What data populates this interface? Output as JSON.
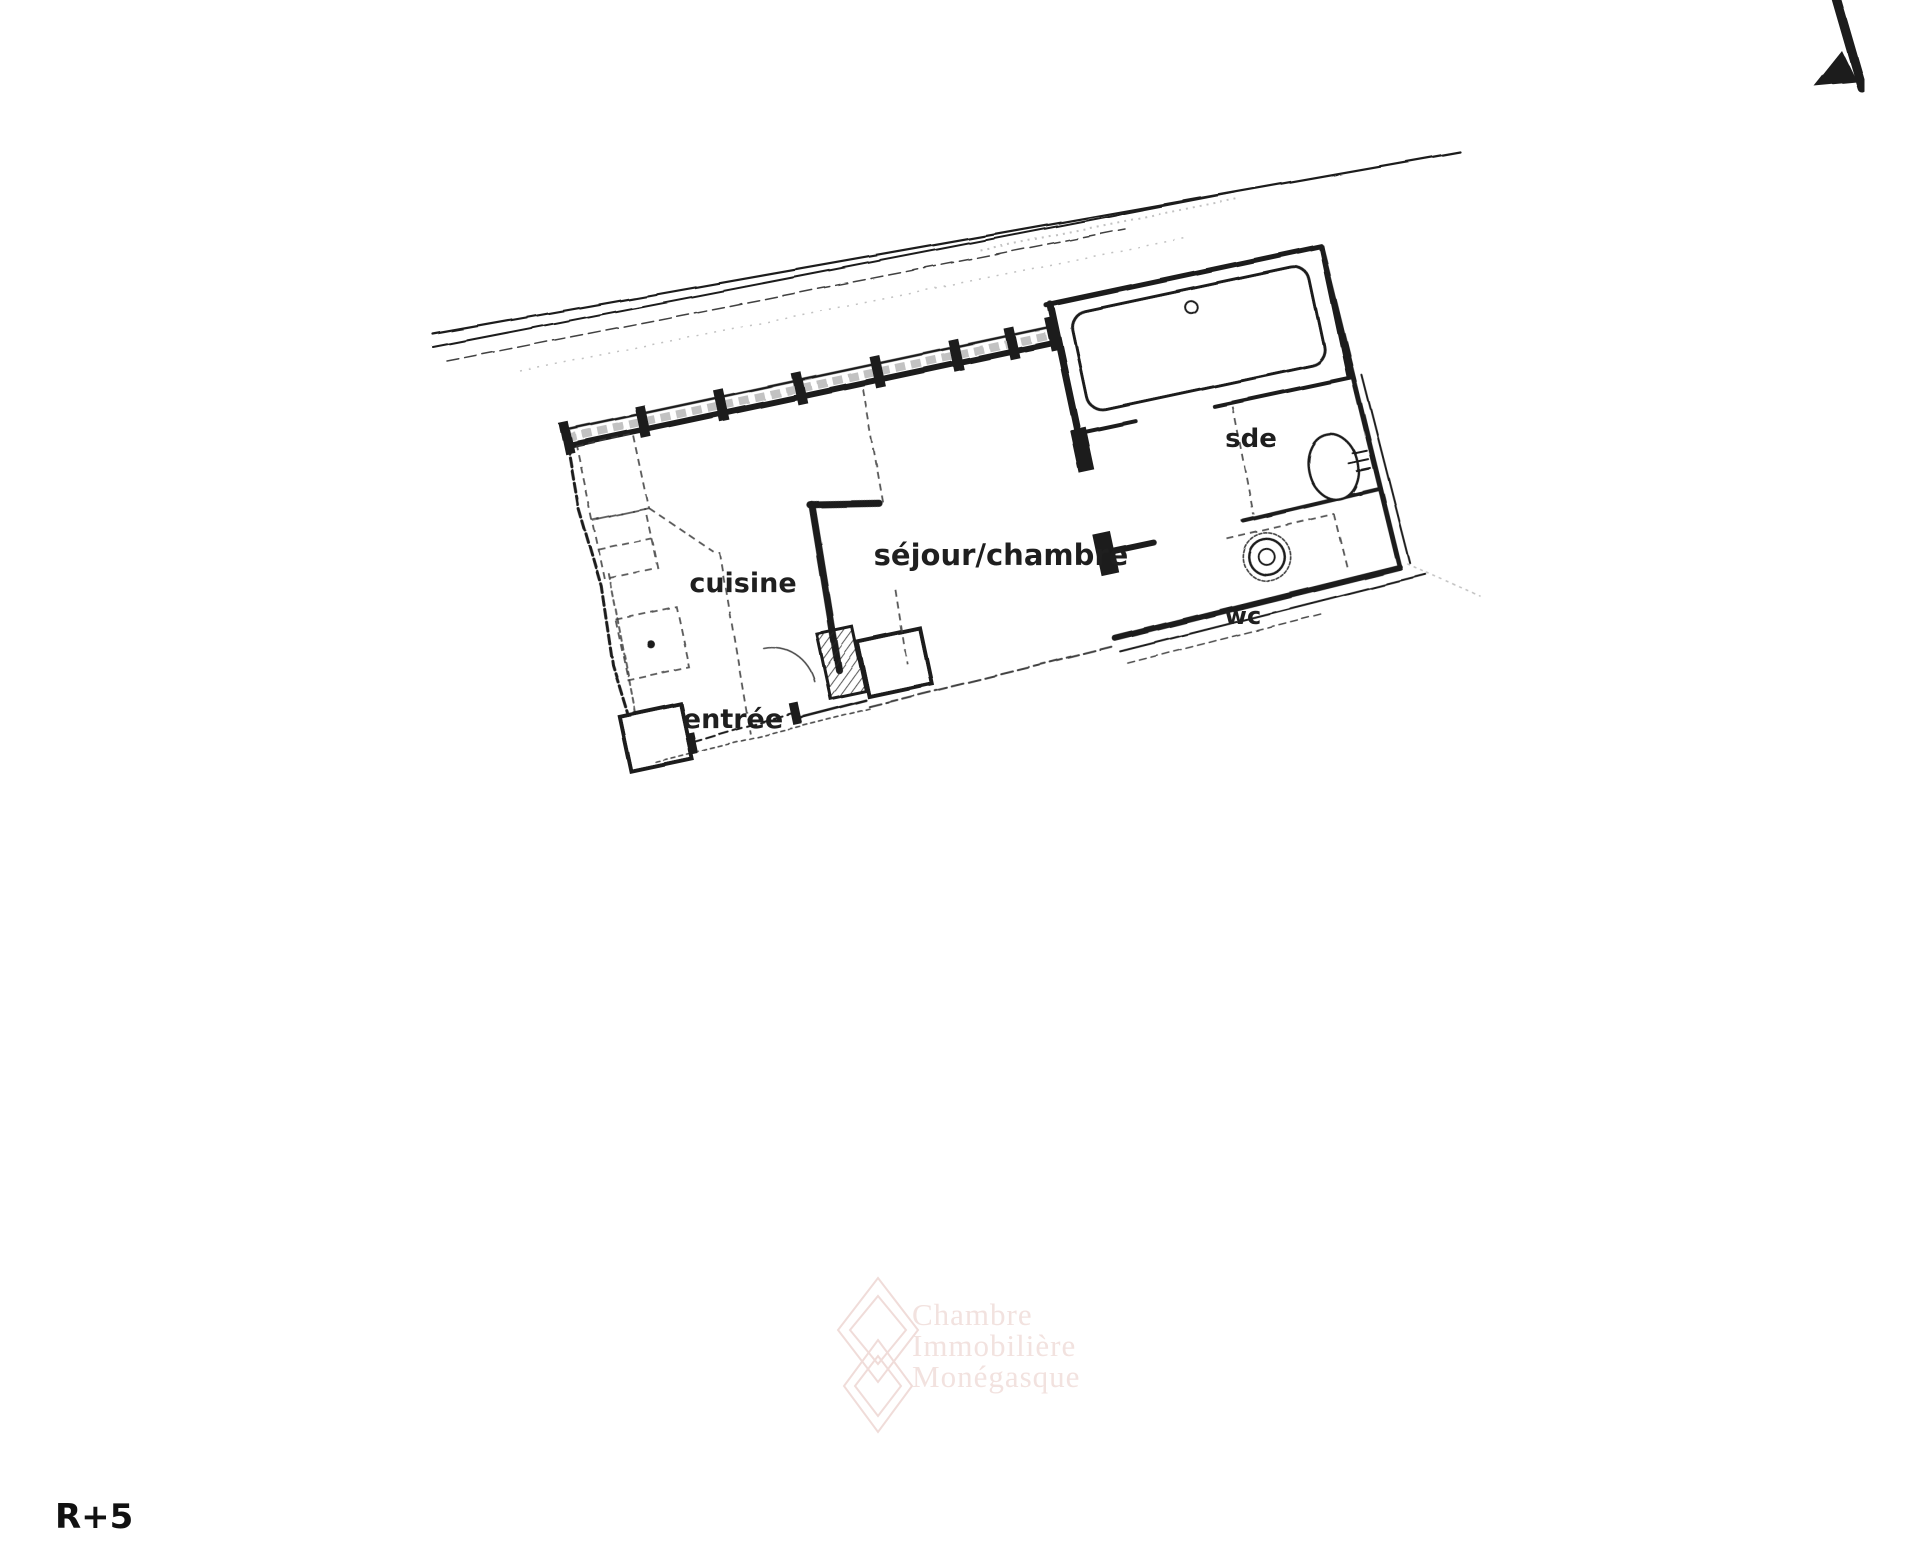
{
  "plan": {
    "room_labels": [
      {
        "id": "cuisine",
        "label": "cuisine"
      },
      {
        "id": "sejour-chambre",
        "label": "séjour/chambre"
      },
      {
        "id": "entree",
        "label": "entrée"
      },
      {
        "id": "sde",
        "label": "sde"
      },
      {
        "id": "wc",
        "label": "wc"
      }
    ],
    "fixtures": [
      "bathtub-icon",
      "sink-icon",
      "toilet-icon"
    ],
    "orientation_icon": "north-arrow-icon"
  },
  "floor_indicator": "R+5",
  "watermark": {
    "lines": [
      "Chambre",
      "Immobilière",
      "Monégasque"
    ],
    "logo": "diamond-logo-icon"
  },
  "colors": {
    "ink": "#1f1f1f",
    "background": "#ffffff",
    "watermark_pink": "#f2e2df"
  }
}
